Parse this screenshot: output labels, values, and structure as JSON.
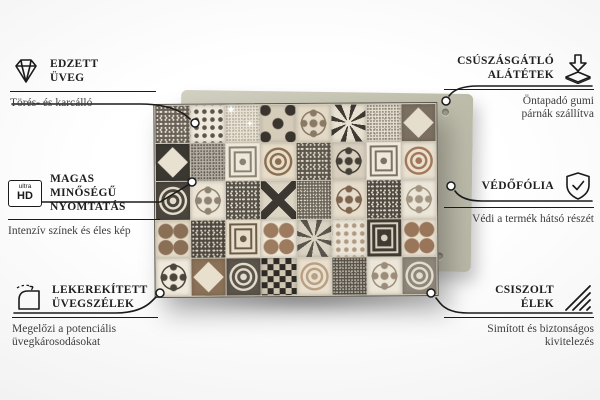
{
  "features": {
    "left": [
      {
        "icon": "diamond-icon",
        "title_lines": [
          "EDZETT",
          "ÜVEG"
        ],
        "subtitle_lines": [
          "Törés- és karcálló"
        ]
      },
      {
        "icon": "ultra-hd-icon",
        "icon_label_top": "ultra",
        "icon_label_bottom": "HD",
        "title_lines": [
          "MAGAS MINŐSÉGŰ",
          "NYOMTATÁS"
        ],
        "subtitle_lines": [
          "Intenzív színek és éles kép"
        ]
      },
      {
        "icon": "rounded-corner-icon",
        "title_lines": [
          "LEKEREKÍTETT",
          "ÜVEGSZÉLEK"
        ],
        "subtitle_lines": [
          "Megelőzi a potenciális",
          "üvegkárosodásokat"
        ]
      }
    ],
    "right": [
      {
        "icon": "anti-slip-pad-icon",
        "title_lines": [
          "CSÚSZÁSGÁTLÓ",
          "ALÁTÉTEK"
        ],
        "subtitle_lines": [
          "Öntapadó gumi",
          "párnák szállítva"
        ]
      },
      {
        "icon": "shield-check-icon",
        "title_lines": [
          "VÉDŐFÓLIA"
        ],
        "subtitle_lines": [
          "Védi a termék hátsó részét"
        ]
      },
      {
        "icon": "polished-edges-icon",
        "title_lines": [
          "CSISZOLT",
          "ÉLEK"
        ],
        "subtitle_lines": [
          "Simított és biztonságos",
          "kivitelezés"
        ]
      }
    ]
  },
  "product": {
    "description": "patchwork tile mosaic glass board",
    "sparkle_glyph": "✦",
    "back_panel_color": "#c6c4b2",
    "grout_color": "#cfc8b8",
    "tiles": [
      {
        "p": "speckle",
        "bg": "#6a6258",
        "fg": "#e8e1d2"
      },
      {
        "p": "dots",
        "bg": "#efe9dc",
        "fg": "#5a544b"
      },
      {
        "p": "lace",
        "bg": "#e9e3d6",
        "fg": "#a89c8a"
      },
      {
        "p": "quatrefoil",
        "bg": "#d6ccba",
        "fg": "#3a362f"
      },
      {
        "p": "flower",
        "bg": "#e3d9c6",
        "fg": "#8a7a64"
      },
      {
        "p": "burst",
        "bg": "#e8e0d0",
        "fg": "#3f3a33"
      },
      {
        "p": "lace",
        "bg": "#e5decf",
        "fg": "#6f675b"
      },
      {
        "p": "diamond",
        "bg": "#7a6f60",
        "fg": "#e6decd"
      },
      {
        "p": "diamond",
        "bg": "#3b3731",
        "fg": "#e8e0d0"
      },
      {
        "p": "lace",
        "bg": "#b5afa4",
        "fg": "#4e4942"
      },
      {
        "p": "frame",
        "bg": "#eee8da",
        "fg": "#8b8274"
      },
      {
        "p": "medallion",
        "bg": "#e7ddc9",
        "fg": "#8b6f52"
      },
      {
        "p": "speckle",
        "bg": "#5d574e",
        "fg": "#e2dac9"
      },
      {
        "p": "flower",
        "bg": "#d8cfbf",
        "fg": "#443f37"
      },
      {
        "p": "frame",
        "bg": "#efe9db",
        "fg": "#7c7366"
      },
      {
        "p": "medallion",
        "bg": "#e9e1d0",
        "fg": "#a3785a"
      },
      {
        "p": "medallion",
        "bg": "#4a453d",
        "fg": "#e5ddcc"
      },
      {
        "p": "flower",
        "bg": "#ece5d6",
        "fg": "#8f8371"
      },
      {
        "p": "speckle",
        "bg": "#57524a",
        "fg": "#ded6c5"
      },
      {
        "p": "cross",
        "bg": "#ddd5c4",
        "fg": "#3c3831"
      },
      {
        "p": "lace",
        "bg": "#6b645a",
        "fg": "#e0d8c7"
      },
      {
        "p": "flower",
        "bg": "#e6dccb",
        "fg": "#7d6550"
      },
      {
        "p": "speckle",
        "bg": "#504b44",
        "fg": "#ddd5c4"
      },
      {
        "p": "flower",
        "bg": "#ece6d8",
        "fg": "#a29582"
      },
      {
        "p": "circles4",
        "bg": "#e5dbc8",
        "fg": "#8a6f57"
      },
      {
        "p": "speckle",
        "bg": "#4e4942",
        "fg": "#d9d1c0"
      },
      {
        "p": "frame",
        "bg": "#e8ddc9",
        "fg": "#6b5b49"
      },
      {
        "p": "circles4",
        "bg": "#efe8d9",
        "fg": "#9c7b5e"
      },
      {
        "p": "burst",
        "bg": "#d9d2c3",
        "fg": "#5b554c"
      },
      {
        "p": "dots",
        "bg": "#ece6d8",
        "fg": "#b09a82"
      },
      {
        "p": "frame",
        "bg": "#3f3b34",
        "fg": "#d9d0bd"
      },
      {
        "p": "circles4",
        "bg": "#e9e0cf",
        "fg": "#99755a"
      },
      {
        "p": "flower",
        "bg": "#efe9db",
        "fg": "#4a453d"
      },
      {
        "p": "diamond",
        "bg": "#8a7157",
        "fg": "#e8dfcd"
      },
      {
        "p": "medallion",
        "bg": "#5a544b",
        "fg": "#e3dbca"
      },
      {
        "p": "check",
        "bg": "#2f2c27",
        "fg": "#cfc6b2"
      },
      {
        "p": "medallion",
        "bg": "#e9dfcc",
        "fg": "#b99f83"
      },
      {
        "p": "lace",
        "bg": "#57524a",
        "fg": "#ddd5c4"
      },
      {
        "p": "flower",
        "bg": "#ece6d8",
        "fg": "#9b8d79"
      },
      {
        "p": "medallion",
        "bg": "#8d867a",
        "fg": "#e5ddcc"
      }
    ]
  },
  "colors": {
    "connector_line": "#1b1b1b",
    "title_text": "#1f1f1f",
    "subtitle_text": "#3d3d3d",
    "board_shadow": "rgba(0,0,0,0.3)"
  }
}
